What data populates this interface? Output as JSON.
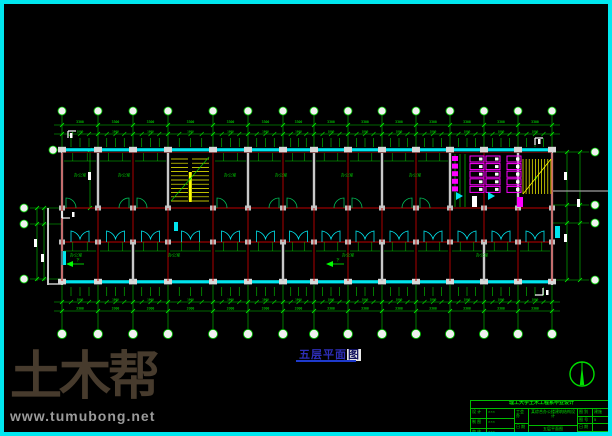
{
  "frame": {
    "border_color": "#00E8F0",
    "background": "#000000"
  },
  "watermark": {
    "brand": "土木帮",
    "url": "www.tumubong.net"
  },
  "drawing_title": {
    "text": "五层平面",
    "highlight_char": "图"
  },
  "labels": {
    "room": "办公室",
    "stair_dir": "下",
    "upper_label_xs": [
      76,
      120,
      226,
      277,
      343,
      411
    ],
    "lower_label_xs": [
      72,
      170,
      344,
      478
    ]
  },
  "dims": {
    "bay": "3300",
    "window": "1800",
    "side": [
      "5400",
      "3000",
      "5400"
    ]
  },
  "plan": {
    "grid_x": [
      58,
      94,
      129,
      164,
      209,
      244,
      279,
      310,
      344,
      378,
      412,
      446,
      480,
      514,
      548
    ],
    "top": {
      "bubble_y": 107,
      "dim1_y": 121,
      "dim2_y": 130,
      "wall_y": 145
    },
    "bottom": {
      "wall_y": 277,
      "dim1_y": 298,
      "dim2_y": 307,
      "bubble_y": 330
    },
    "left": {
      "bubble_x": 20,
      "rows_y": [
        204,
        220,
        275
      ],
      "extra_bubble_x": 49,
      "extra_bubble_y": 146
    },
    "right": {
      "bubble_x": 591,
      "rows_y": [
        148,
        201,
        219,
        276
      ],
      "chain_x": [
        563,
        576
      ]
    },
    "corridor": {
      "top_y": 204,
      "bot_y": 238
    },
    "upper_partitions": [
      94,
      164,
      244,
      310,
      378,
      446,
      514
    ],
    "lower_partitions": [
      129,
      279,
      378,
      480
    ],
    "door_skip_bays": [
      3,
      11,
      12,
      13
    ],
    "colors": {
      "grid_green": "#00CC00",
      "bright_green": "#00FF00",
      "column_red": "#C00000",
      "dark_red": "#7A0000",
      "wall_gray": "#C8C8C8",
      "window_cyan": "#00E5EE",
      "stair_yellow": "#FFFF00",
      "toilet_magenta": "#FF00FF",
      "white": "#FFFFFF",
      "label_green": "#00C800"
    }
  },
  "title_block": {
    "header": "理工大学土木工程系毕业设计",
    "left_rows": [
      [
        "设 计",
        "×××"
      ],
      [
        "制 图",
        "×××"
      ],
      [
        "审 核",
        "×××"
      ]
    ],
    "mid_rows": [
      "工会办",
      "日 期"
    ],
    "project": "某综合办公楼建筑结构设计",
    "drawing": "五层平面图",
    "right_rows": [
      [
        "图 别",
        "建施"
      ],
      [
        "图 号",
        "5"
      ],
      [
        "日 期",
        ""
      ],
      [
        "比 例",
        "1:100"
      ]
    ]
  }
}
